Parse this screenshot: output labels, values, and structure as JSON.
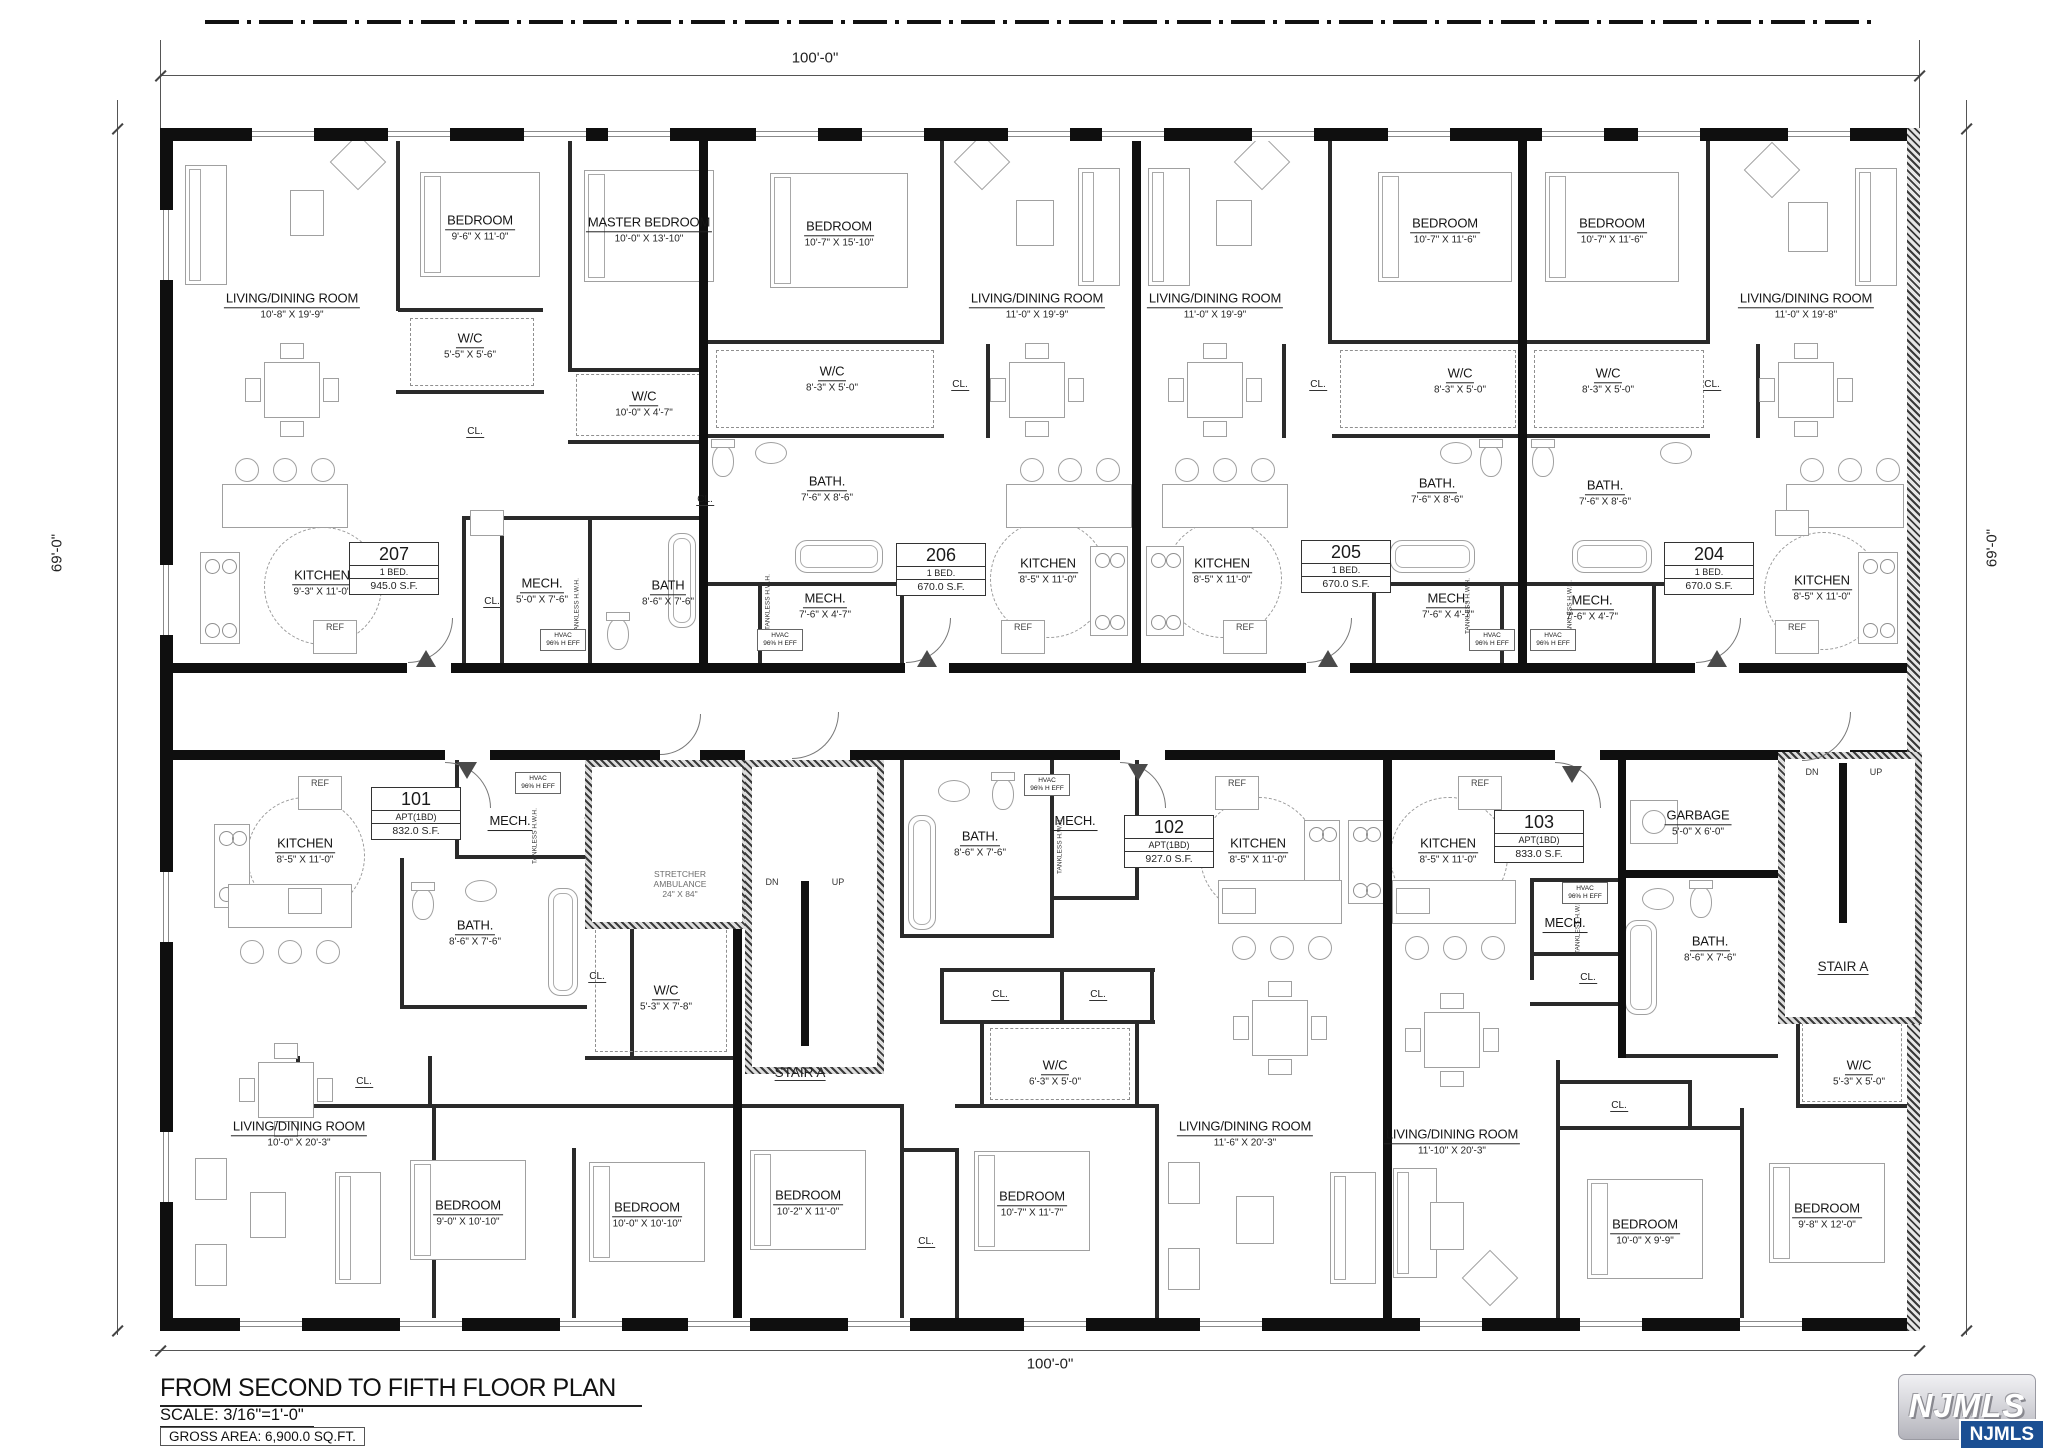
{
  "plan": {
    "title": "FROM SECOND TO FIFTH  FLOOR PLAN",
    "scale_label": "SCALE: 3/16\"=1'-0\"",
    "gross_area_label": "GROSS AREA: 6,900.0 SQ.FT.",
    "dim_top": "100'-0\"",
    "dim_bottom": "100'-0\"",
    "dim_left": "69'-0\"",
    "dim_right": "69'-0\""
  },
  "logo": {
    "name": "NJMLS",
    "badge": "NJMLS"
  },
  "units": {
    "u207": {
      "number": "207",
      "type": "1 BED.",
      "area": "945.0 S.F."
    },
    "u206": {
      "number": "206",
      "type": "1 BED.",
      "area": "670.0 S.F."
    },
    "u205": {
      "number": "205",
      "type": "1 BED.",
      "area": "670.0 S.F."
    },
    "u204": {
      "number": "204",
      "type": "1 BED.",
      "area": "670.0 S.F."
    },
    "u101": {
      "number": "101",
      "type": "APT(1BD)",
      "area": "832.0 S.F."
    },
    "u102": {
      "number": "102",
      "type": "APT(1BD)",
      "area": "927.0 S.F."
    },
    "u103": {
      "number": "103",
      "type": "APT(1BD)",
      "area": "833.0 S.F."
    }
  },
  "rooms": {
    "living207": {
      "name": "LIVING/DINING ROOM",
      "dims": "10'-8\" X 19'-9\""
    },
    "bed207": {
      "name": "BEDROOM",
      "dims": "9'-6\" X 11'-0\""
    },
    "master207": {
      "name": "MASTER BEDROOM",
      "dims": "10'-0\" X 13'-10\""
    },
    "wc207a": {
      "name": "W/C",
      "dims": "5'-5\" X 5'-6\""
    },
    "wc207b": {
      "name": "W/C",
      "dims": "10'-0\" X 4'-7\""
    },
    "kitchen207": {
      "name": "KITCHEN",
      "dims": "9'-3\" X 11'-0\""
    },
    "mech207": {
      "name": "MECH.",
      "dims": "5'-0\" X 7'-6\""
    },
    "bath207": {
      "name": "BATH",
      "dims": "8'-6\" X 7'-6\""
    },
    "bed206": {
      "name": "BEDROOM",
      "dims": "10'-7\" X 15'-10\""
    },
    "living206": {
      "name": "LIVING/DINING ROOM",
      "dims": "11'-0\" X 19'-9\""
    },
    "wc206": {
      "name": "W/C",
      "dims": "8'-3\" X 5'-0\""
    },
    "bath206": {
      "name": "BATH.",
      "dims": "7'-6\" X 8'-6\""
    },
    "mech206": {
      "name": "MECH.",
      "dims": "7'-6\" X 4'-7\""
    },
    "kitchen206": {
      "name": "KITCHEN",
      "dims": "8'-5\" X 11'-0\""
    },
    "living205": {
      "name": "LIVING/DINING ROOM",
      "dims": "11'-0\" X 19'-9\""
    },
    "bed205": {
      "name": "BEDROOM",
      "dims": "10'-7\" X 11'-6\""
    },
    "wc205": {
      "name": "W/C",
      "dims": "8'-3\" X 5'-0\""
    },
    "bath205": {
      "name": "BATH.",
      "dims": "7'-6\" X 8'-6\""
    },
    "mech205": {
      "name": "MECH.",
      "dims": "7'-6\" X 4'-7\""
    },
    "kitchen205": {
      "name": "KITCHEN",
      "dims": "8'-5\" X 11'-0\""
    },
    "bed204": {
      "name": "BEDROOM",
      "dims": "10'-7\" X 11'-6\""
    },
    "living204": {
      "name": "LIVING/DINING ROOM",
      "dims": "11'-0\" X 19'-8\""
    },
    "wc204": {
      "name": "W/C",
      "dims": "8'-3\" X 5'-0\""
    },
    "bath204": {
      "name": "BATH.",
      "dims": "7'-6\" X 8'-6\""
    },
    "mech204": {
      "name": "MECH.",
      "dims": "7'-6\" X 4'-7\""
    },
    "kitchen204": {
      "name": "KITCHEN",
      "dims": "8'-5\" X 11'-0\""
    },
    "kitchen101": {
      "name": "KITCHEN",
      "dims": "8'-5\" X 11'-0\""
    },
    "mech101": {
      "name": "MECH.",
      "dims": ""
    },
    "bath101": {
      "name": "BATH.",
      "dims": "8'-6\" X 7'-6\""
    },
    "wc101": {
      "name": "W/C",
      "dims": "5'-3\" X 7'-8\""
    },
    "living101": {
      "name": "LIVING/DINING ROOM",
      "dims": "10'-0\" X 20'-3\""
    },
    "bed101a": {
      "name": "BEDROOM",
      "dims": "9'-0\" X 10'-10\""
    },
    "bed101b": {
      "name": "BEDROOM",
      "dims": "10'-0\" X 10'-10\""
    },
    "bath102": {
      "name": "BATH.",
      "dims": "8'-6\" X 7'-6\""
    },
    "mech102": {
      "name": "MECH.",
      "dims": ""
    },
    "kitchen102": {
      "name": "KITCHEN",
      "dims": "8'-5\" X 11'-0\""
    },
    "wc102": {
      "name": "W/C",
      "dims": "6'-3\" X 5'-0\""
    },
    "living102": {
      "name": "LIVING/DINING ROOM",
      "dims": "11'-6\" X 20'-3\""
    },
    "bed102a": {
      "name": "BEDROOM",
      "dims": "10'-2\" X 11'-0\""
    },
    "bed102b": {
      "name": "BEDROOM",
      "dims": "10'-7\" X 11'-7\""
    },
    "kitchen103": {
      "name": "KITCHEN",
      "dims": "8'-5\" X 11'-0\""
    },
    "mech103": {
      "name": "MECH.",
      "dims": ""
    },
    "bath103": {
      "name": "BATH.",
      "dims": "8'-6\" X 7'-6\""
    },
    "wc103": {
      "name": "W/C",
      "dims": "5'-3\" X 5'-0\""
    },
    "living103": {
      "name": "LIVING/DINING ROOM",
      "dims": "11'-10\" X 20'-3\""
    },
    "bed103a": {
      "name": "BEDROOM",
      "dims": "10'-0\" X 9'-9\""
    },
    "bed103b": {
      "name": "BEDROOM",
      "dims": "9'-8\" X 12'-0\""
    },
    "garbage": {
      "name": "GARBAGE",
      "dims": "5'-0\" X 6'-0\""
    }
  },
  "labels": {
    "cl": "CL.",
    "ref": "REF",
    "dn": "DN",
    "up": "UP",
    "stair_a": "STAIR A",
    "hvac1": "HVAC",
    "hvac2": "96% H EFF",
    "tankless": "TANKLESS H.W.H.",
    "elev1": "STRETCHER",
    "elev2": "AMBULANCE",
    "elev3": "24\" X 84\""
  }
}
